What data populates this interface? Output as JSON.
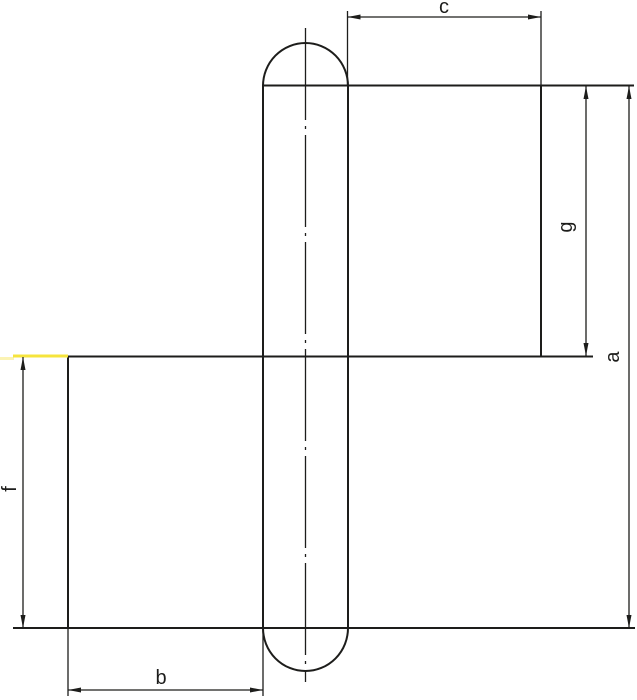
{
  "drawing": {
    "kind": "hinge-dimension-drawing",
    "dimensions": {
      "a": {
        "label": "a"
      },
      "b": {
        "label": "b"
      },
      "c": {
        "label": "c"
      },
      "f": {
        "label": "f"
      },
      "g": {
        "label": "g"
      }
    }
  },
  "colors": {
    "background": "#ffffff",
    "line": "#1d1d1b",
    "highlight": "#f6e43c",
    "highlight_faint": "#fbf3b4"
  }
}
